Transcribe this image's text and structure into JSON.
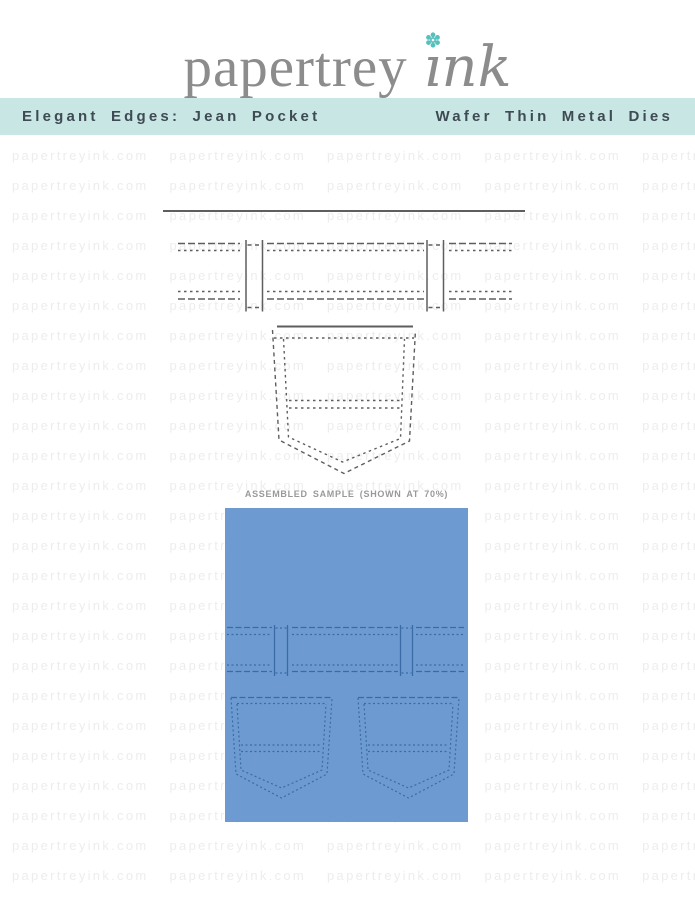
{
  "logo": {
    "brand": "papertrey",
    "suffix": "ınk",
    "brand_color": "#8c8c8c",
    "flower_color": "#57c0bc"
  },
  "banner": {
    "left": "Elegant Edges: Jean Pocket",
    "right": "Wafer Thin Metal Dies",
    "bg": "#c8e6e3",
    "text_color": "#3e4b54"
  },
  "watermark": {
    "text": "papertreyink.com",
    "color": "#ededed",
    "rows": 25,
    "cols": 5,
    "row_spacing_px": 30
  },
  "dies": {
    "line_color": "#5e5e5e",
    "items": [
      "straight-edge-die",
      "waistband-with-belt-loops-die",
      "jean-pocket-die"
    ]
  },
  "sample": {
    "caption": "ASSEMBLED SAMPLE (SHOWN AT 70%)",
    "caption_color": "#999999",
    "card_color": "#6d9bd1",
    "stitch_color": "#3a6ba6"
  }
}
